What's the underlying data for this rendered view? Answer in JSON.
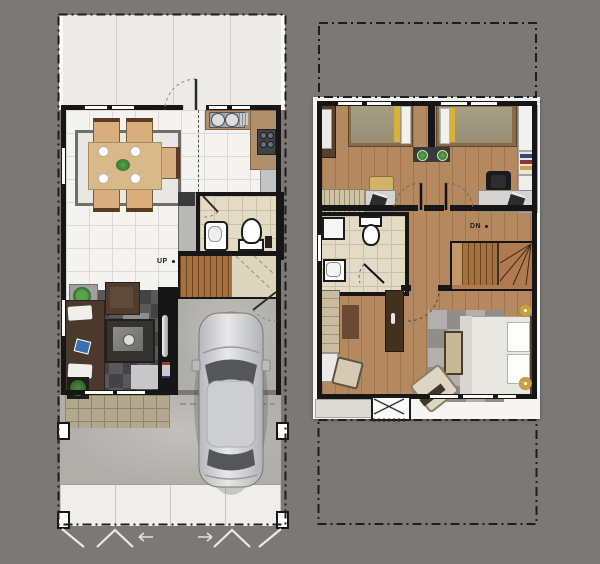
{
  "labels": {
    "ground_stairs": "UP",
    "upper_stairs": "DN"
  },
  "palette": {
    "background": "#7b7876",
    "wall": "#161616",
    "floor_tile": "#f4f3f0",
    "terrace_tile": "#edebe7",
    "wood_floor": "#b5895f",
    "stair_wood": "#a5713f",
    "bath_tile": "#e3dbc5",
    "kitchen_counter": "#b08f6d",
    "living_rug": "#434345",
    "sofa_brown": "#4a392c",
    "dining_wood": "#d9b98a",
    "bed_olive": "#9e977c",
    "bed_white": "#e9e7e2",
    "accent_yellow": "#d8b13c",
    "plant_green": "#3f8a3c",
    "car_silver": "#cfd0d2",
    "lamp_gold": "#c9a03d",
    "concrete": "#b4b2ad"
  }
}
